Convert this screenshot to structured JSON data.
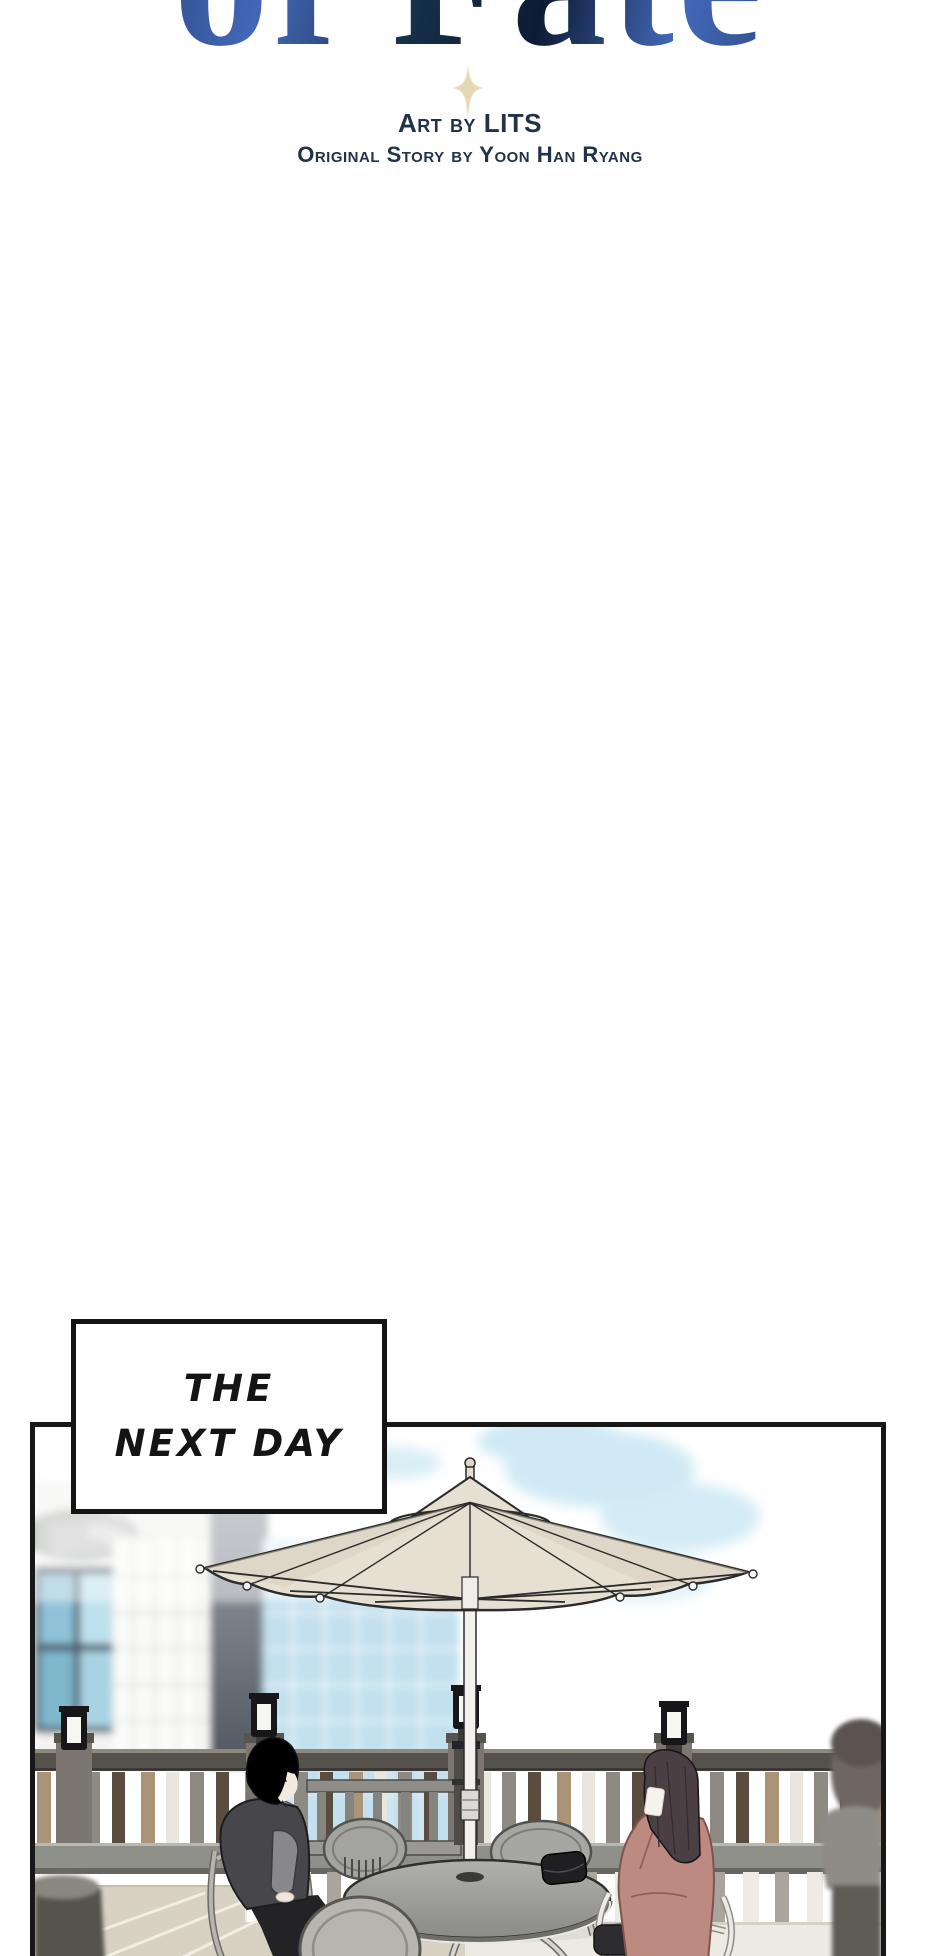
{
  "page": {
    "bg": "#ffffff"
  },
  "header": {
    "title_fragment": "of Fate",
    "credit_line1": "Art by LITS",
    "credit_line2": "Original Story by Yoon Han Ryang"
  },
  "caption_box": {
    "line1": "THE",
    "line2": "NEXT DAY"
  },
  "scene": {
    "objects": [
      "parasol-umbrella",
      "round-cafe-table",
      "black-purse",
      "cafe-chairs",
      "terrace-railing",
      "lamp-posts",
      "garden-bench",
      "glass-buildings",
      "man-in-dark-hoodie",
      "woman-in-rose-coat",
      "blurred-bystander"
    ]
  },
  "theme": {
    "pageBg": "#ffffff",
    "ink": "#141414",
    "credit": "#223349",
    "titleA": "#0d1c36",
    "titleB": "#27487f",
    "titleC": "#4468b8",
    "titleD": "#153048",
    "sparkle": "#ded2a6",
    "sky": "#cfeaf4",
    "glass": "#c3e0ee",
    "tealGlass": "#8fc2d8",
    "column": "#5b616b",
    "umbrella": "#e6e0d3",
    "umbrellaShade": "#d7cfbe",
    "railDark": "#55524c",
    "slatTan": "#ab9478",
    "slatWhite": "#e9e6df",
    "slatGray": "#8d8a84",
    "slatBrown": "#5a4d40",
    "beam": "#90908a",
    "floor": "#d8d2c4",
    "table": "#9e9e9a",
    "chair": "#a3a39f",
    "chairLight": "#b8b5b0",
    "lamp": "#17171a",
    "hairMan": "#26262a",
    "jacket": "#47474b",
    "hood": "#8f8f93",
    "hairWoman": "#4a4044",
    "coat": "#bd8a82",
    "figure": "#8f8b86"
  }
}
